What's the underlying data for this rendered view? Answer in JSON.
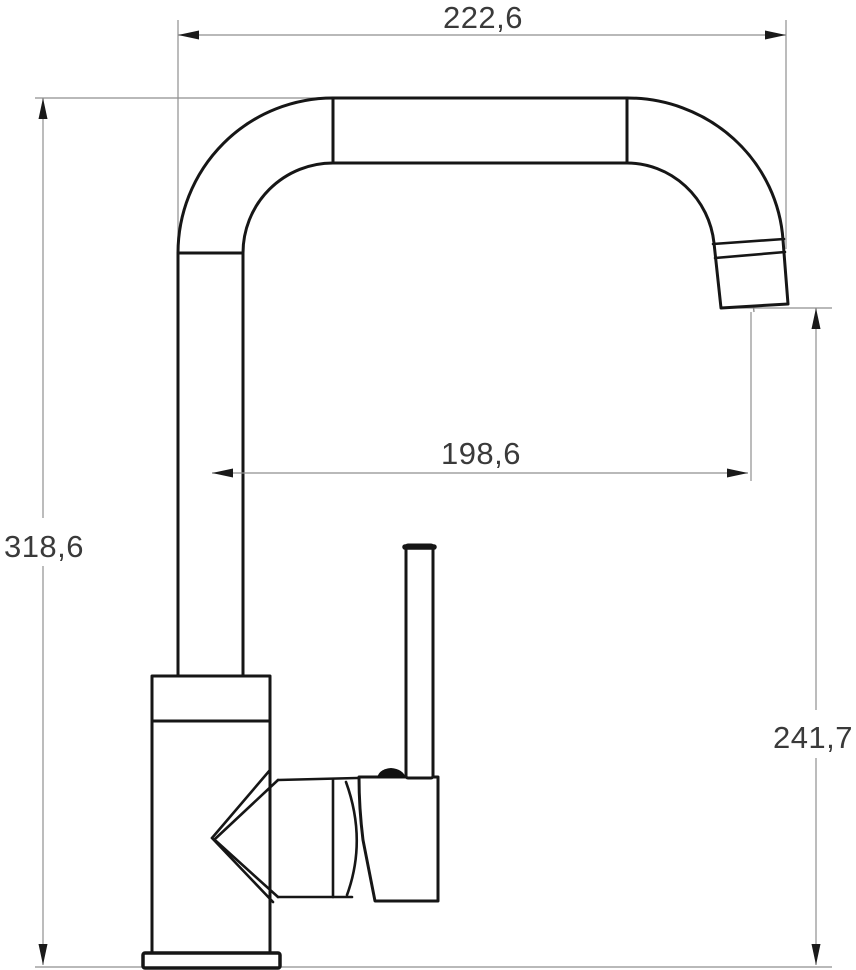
{
  "drawing": {
    "kind": "technical-dimension-drawing",
    "subject": "single-lever high-arc kitchen faucet, side elevation",
    "background_color": "#ffffff",
    "outline_color": "#161616",
    "dimension_line_color": "#8f8f8f",
    "label_color": "#3a3a3a",
    "dimensions": {
      "top_width": {
        "label": "222,6",
        "value": 222.6
      },
      "overall_height": {
        "label": "318,6",
        "value": 318.6
      },
      "spout_reach": {
        "label": "198,6",
        "value": 198.6
      },
      "outlet_height": {
        "label": "241,7",
        "value": 241.7
      }
    }
  }
}
